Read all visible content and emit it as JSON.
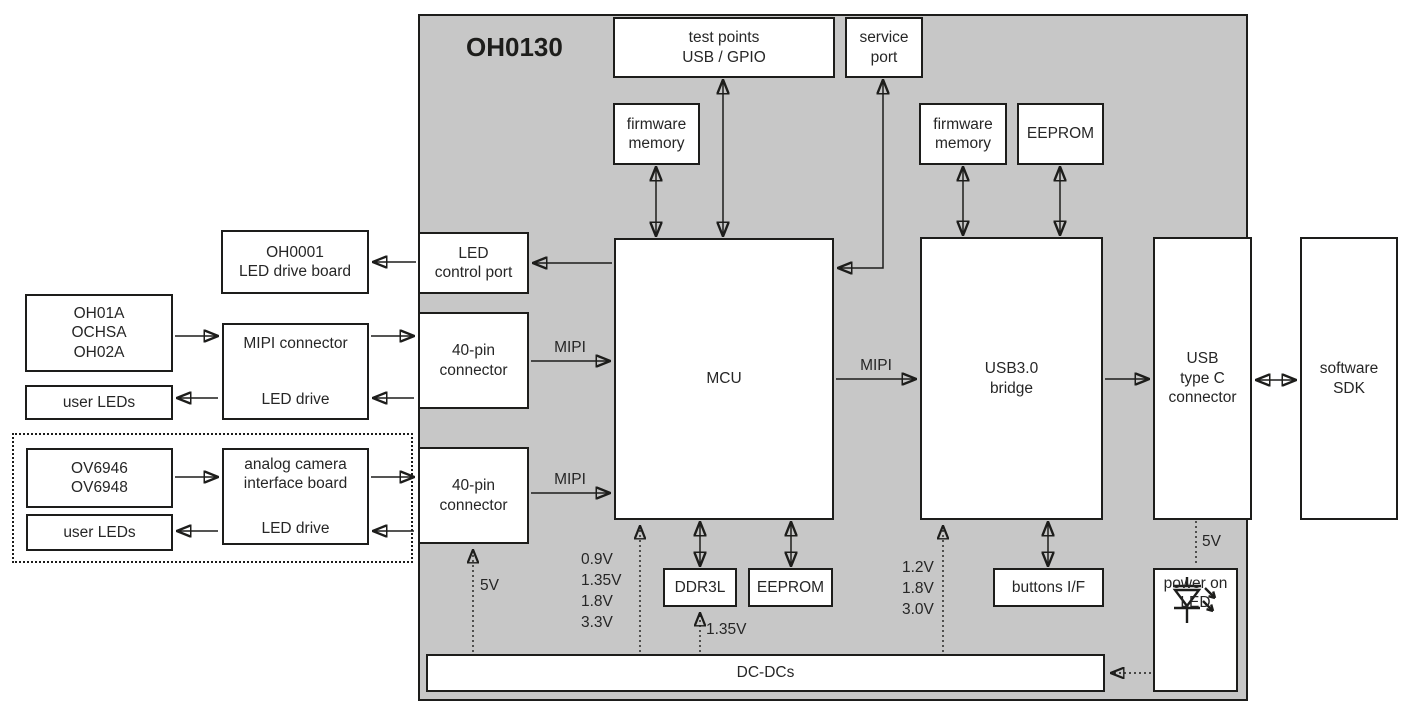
{
  "title": "OH0130",
  "boxes": {
    "test_points": "test points\nUSB / GPIO",
    "service_port": "service\nport",
    "firmware_memory_mcu": "firmware\nmemory",
    "firmware_memory_usb": "firmware\nmemory",
    "eeprom_top": "EEPROM",
    "oh0001_board": "OH0001\nLED drive board",
    "led_control_port": "LED\ncontrol port",
    "mipi_sensors": "OH01A\nOCHSA\nOH02A",
    "mipi_connector_top": "MIPI connector",
    "mipi_connector_bottom": "LED drive",
    "user_leds_top": "user LEDs",
    "pin40_top": "40-pin\nconnector",
    "analog_sensors": "OV6946\nOV6948",
    "analog_board_top": "analog camera\ninterface board",
    "analog_board_bottom": "LED drive",
    "user_leds_bottom": "user LEDs",
    "pin40_bottom": "40-pin\nconnector",
    "mcu": "MCU",
    "usb3_bridge": "USB3.0\nbridge",
    "usb_type_c": "USB\ntype C\nconnector",
    "software_sdk": "software\nSDK",
    "ddr3l": "DDR3L",
    "eeprom_bottom": "EEPROM",
    "buttons_if": "buttons I/F",
    "power_on_led": "power on\nLED",
    "dc_dcs": "DC-DCs"
  },
  "bus_labels": {
    "mipi_cam1": "MIPI",
    "mipi_cam2": "MIPI",
    "mipi_out": "MIPI"
  },
  "rails": {
    "mcu_supplies": "0.9V\n1.35V\n1.8V\n3.3V",
    "ddr_supply": "1.35V",
    "usb_bridge_supplies": "1.2V\n1.8V\n3.0V",
    "pin40_supply": "5V",
    "power_led_supply": "5V"
  },
  "colors": {
    "board_fill": "#c7c7c7",
    "line": "#1d1d1b",
    "text": "#262626"
  }
}
